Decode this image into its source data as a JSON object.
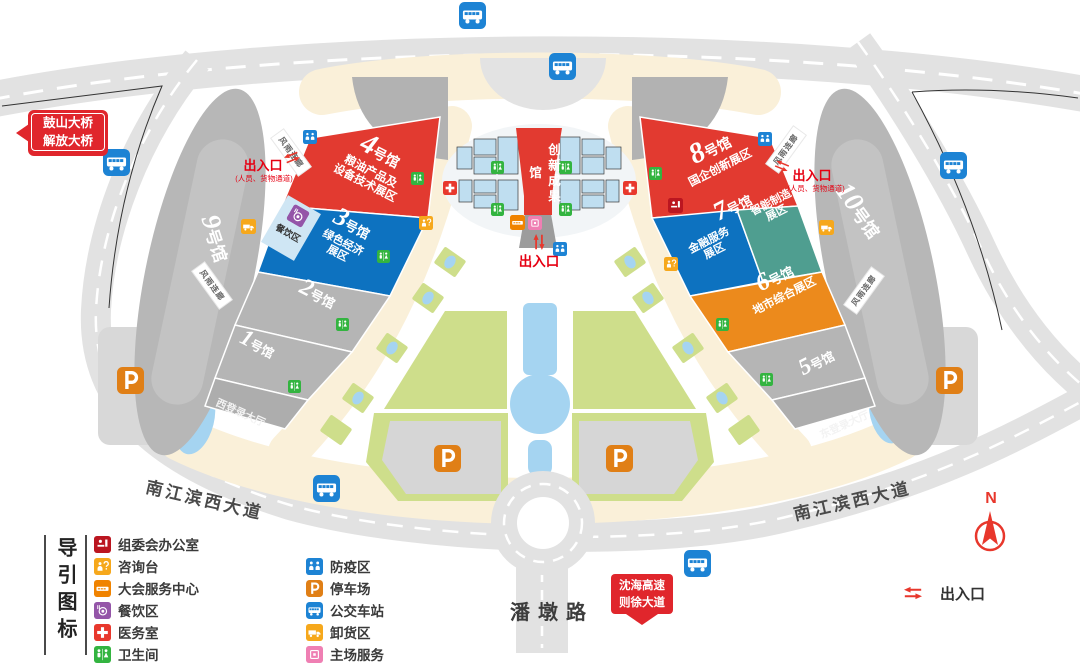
{
  "halls": {
    "h1": {
      "num": "1",
      "suffix": "号馆"
    },
    "h2": {
      "num": "2",
      "suffix": "号馆"
    },
    "h3": {
      "num": "3",
      "suffix": "号馆",
      "zone": "绿色经济\n展区"
    },
    "h4": {
      "num": "4",
      "suffix": "号馆",
      "zone": "粮油产品及\n设备技术展区"
    },
    "h5": {
      "num": "5",
      "suffix": "号馆"
    },
    "h6": {
      "num": "6",
      "suffix": "号馆",
      "zone": "地市综合展区"
    },
    "h7": {
      "num": "7",
      "suffix": "号馆",
      "zone_finance": "金融服务\n展区",
      "zone_smart": "智能制造\n展区"
    },
    "h8": {
      "num": "8",
      "suffix": "号馆",
      "zone": "国企创新展区"
    },
    "h9": {
      "num": "9",
      "suffix": "号馆"
    },
    "h10": {
      "num": "10",
      "suffix": "号馆"
    },
    "innovation": "创新成果馆",
    "west_lobby": "西登录大厅",
    "east_lobby": "东登录大厅"
  },
  "labels": {
    "corridor": "风雨连廊",
    "dining_area": "餐饮区",
    "exit": "出入口",
    "exit_note": "(人员、货物通道)",
    "bridge": "鼓山大桥\n解放大桥",
    "highway": "沈海高速\n则徐大道",
    "road_southwest": "南江滨西大道",
    "road_southeast": "南江滨西大道",
    "road_south": "潘墩路",
    "compass": "N"
  },
  "legend": {
    "title": "导引图标",
    "col1": [
      {
        "icon": "committee-icon",
        "label": "组委会办公室"
      },
      {
        "icon": "info-desk-icon",
        "label": "咨询台"
      },
      {
        "icon": "service-center-icon",
        "label": "大会服务中心"
      },
      {
        "icon": "dining-icon",
        "label": "餐饮区"
      },
      {
        "icon": "medical-icon",
        "label": "医务室"
      },
      {
        "icon": "toilet-icon",
        "label": "卫生间"
      }
    ],
    "col2": [
      {
        "icon": "quarantine-icon",
        "label": "防疫区"
      },
      {
        "icon": "parking-icon",
        "label": "停车场"
      },
      {
        "icon": "bus-station-icon",
        "label": "公交车站"
      },
      {
        "icon": "unloading-icon",
        "label": "卸货区"
      },
      {
        "icon": "host-service-icon",
        "label": "主场服务"
      }
    ],
    "exit_label": "出入口"
  },
  "colors": {
    "hall_red": "#e23a30",
    "hall_blue": "#0d72c0",
    "hall_teal": "#4f9e90",
    "hall_orange": "#ec8a1c",
    "accent_red": "#e60012"
  }
}
